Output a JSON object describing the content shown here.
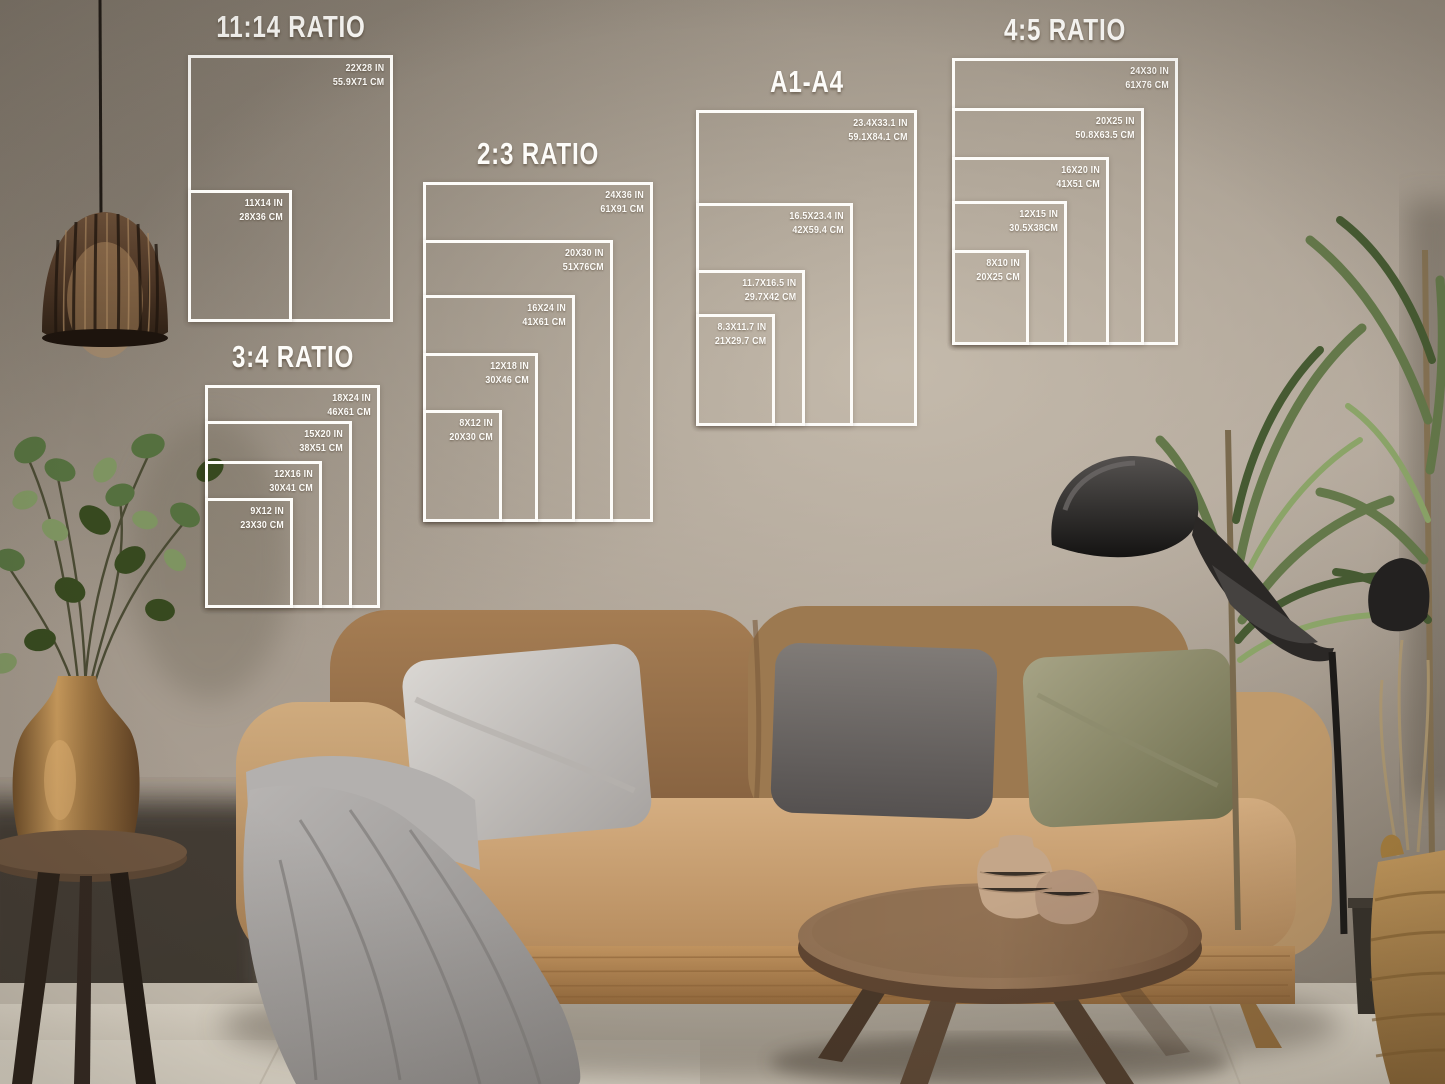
{
  "overlay": {
    "line_color": "#fdfcf9",
    "guides": [
      {
        "title": "11:14 RATIO",
        "frame": {
          "x": 188,
          "y": 55,
          "w": 205,
          "h": 267
        },
        "sizes": [
          {
            "in": "22X28 IN",
            "cm": "55.9X71 CM",
            "w": 205,
            "h": 267
          },
          {
            "in": "11X14 IN",
            "cm": "28X36 CM",
            "w": 104,
            "h": 132
          }
        ]
      },
      {
        "title": "2:3 RATIO",
        "frame": {
          "x": 423,
          "y": 182,
          "w": 230,
          "h": 340
        },
        "sizes": [
          {
            "in": "24X36 IN",
            "cm": "61X91 CM",
            "w": 230,
            "h": 340
          },
          {
            "in": "20X30 IN",
            "cm": "51X76CM",
            "w": 190,
            "h": 282
          },
          {
            "in": "16X24 IN",
            "cm": "41X61 CM",
            "w": 152,
            "h": 227
          },
          {
            "in": "12X18 IN",
            "cm": "30X46 CM",
            "w": 115,
            "h": 169
          },
          {
            "in": "8X12 IN",
            "cm": "20X30 CM",
            "w": 79,
            "h": 112
          }
        ]
      },
      {
        "title": "3:4 RATIO",
        "frame": {
          "x": 205,
          "y": 385,
          "w": 175,
          "h": 223
        },
        "sizes": [
          {
            "in": "18X24 IN",
            "cm": "46X61 CM",
            "w": 175,
            "h": 223
          },
          {
            "in": "15X20 IN",
            "cm": "38X51 CM",
            "w": 147,
            "h": 187
          },
          {
            "in": "12X16 IN",
            "cm": "30X41 CM",
            "w": 117,
            "h": 147
          },
          {
            "in": "9X12 IN",
            "cm": "23X30 CM",
            "w": 88,
            "h": 110
          }
        ]
      },
      {
        "title": "A1-A4",
        "frame": {
          "x": 696,
          "y": 110,
          "w": 221,
          "h": 316
        },
        "sizes": [
          {
            "in": "23.4X33.1 IN",
            "cm": "59.1X84.1 CM",
            "w": 221,
            "h": 316
          },
          {
            "in": "16.5X23.4 IN",
            "cm": "42X59.4 CM",
            "w": 157,
            "h": 223
          },
          {
            "in": "11.7X16.5 IN",
            "cm": "29.7X42 CM",
            "w": 109,
            "h": 156
          },
          {
            "in": "8.3X11.7 IN",
            "cm": "21X29.7 CM",
            "w": 79,
            "h": 112
          }
        ]
      },
      {
        "title": "4:5 RATIO",
        "frame": {
          "x": 952,
          "y": 58,
          "w": 226,
          "h": 287
        },
        "sizes": [
          {
            "in": "24X30 IN",
            "cm": "61X76 CM",
            "w": 226,
            "h": 287
          },
          {
            "in": "20X25 IN",
            "cm": "50.8X63.5 CM",
            "w": 192,
            "h": 237
          },
          {
            "in": "16X20 IN",
            "cm": "41X51 CM",
            "w": 157,
            "h": 188
          },
          {
            "in": "12X15 IN",
            "cm": "30.5X38CM",
            "w": 115,
            "h": 144
          },
          {
            "in": "8X10 IN",
            "cm": "20X25 CM",
            "w": 77,
            "h": 95
          }
        ]
      }
    ]
  },
  "scene": {
    "palette": {
      "wall": "#a89e91",
      "wall_shadow": "#6e665c",
      "sofa_body": "#c4a074",
      "sofa_back": "#97744e",
      "pillow_silver": "#c8c5c1",
      "pillow_dark_gray": "#6b6663",
      "pillow_olive": "#8d8a6b",
      "throw_blanket": "#a3a09e",
      "coffee_table": "#6e513b",
      "brass_vase": "#a97f4e",
      "plant_green": "#5d7344",
      "lamp_black": "#1e1c1a",
      "floor": "#e3dccf",
      "basket": "#b8914f"
    }
  }
}
